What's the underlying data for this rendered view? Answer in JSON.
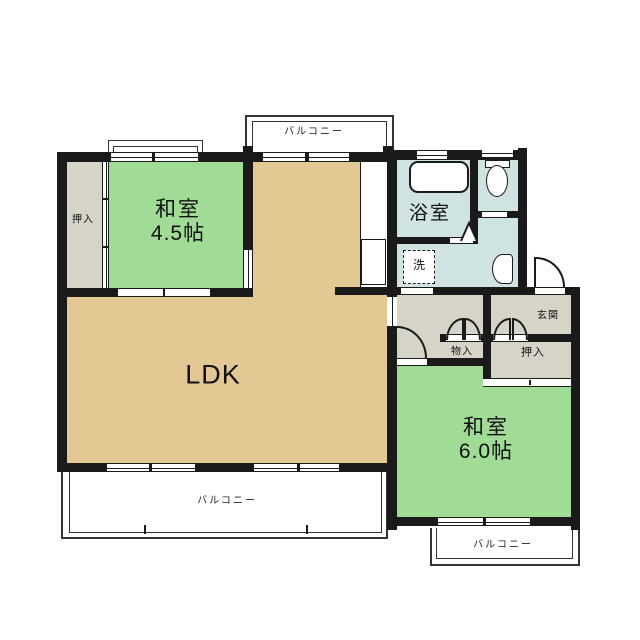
{
  "title": "2DK apartment floor plan",
  "colors": {
    "wall": "#1a1a1a",
    "tatami": "#a0dc96",
    "ldk": "#e3c894",
    "wet": "#cfe3e3",
    "storage": "#d6d3c7"
  },
  "rooms": {
    "washitsu_45": {
      "name": "和室",
      "size": "4.5帖"
    },
    "washitsu_60": {
      "name": "和室",
      "size": "6.0帖"
    },
    "ldk": {
      "name": "LDK"
    },
    "bathroom": {
      "name": "浴室"
    },
    "laundry": {
      "name": "洗"
    },
    "genkan": {
      "name": "玄関"
    },
    "closet_left": {
      "name": "押入"
    },
    "closet_right": {
      "name": "押入"
    },
    "storage_small": {
      "name": "物入"
    },
    "balcony_top": {
      "name": "バルコニー"
    },
    "balcony_main": {
      "name": "バルコニー"
    },
    "balcony_right": {
      "name": "バルコニー"
    }
  }
}
